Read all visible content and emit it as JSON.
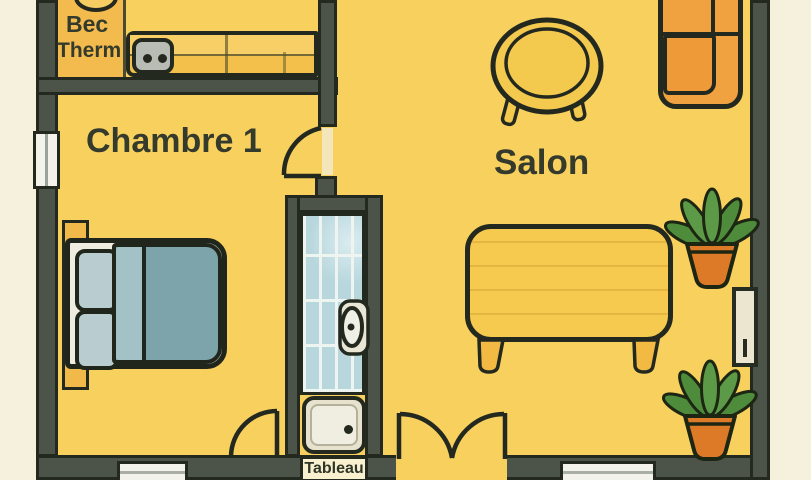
{
  "plan": {
    "rooms": {
      "kitchen": {
        "label_bec": "Bec",
        "label_therm": "Therm"
      },
      "bedroom": {
        "label": "Chambre 1"
      },
      "living_room": {
        "label": "Salon"
      },
      "electrical_panel": {
        "label": "Tableau"
      }
    },
    "furniture_icons": [
      "stove-burner",
      "power-outlet",
      "kitchen-counter",
      "double-bed",
      "pillow",
      "pillow",
      "coffee-table",
      "yellow-sofa",
      "orange-sectional-sofa",
      "toilet",
      "shower-tray",
      "wall-panel",
      "potted-plant",
      "potted-plant",
      "door-swing",
      "door-swing",
      "double-door-swing",
      "window",
      "window",
      "window"
    ],
    "colors": {
      "background_outside": "#f6f1dd",
      "wall": "#4c5349",
      "outline": "#23291f",
      "floor": "#f8d05e",
      "alcove": "#f3ba4d",
      "counter": "#f3c04c",
      "bed_blanket": "#7ca4aa",
      "bed_fold": "#a3c2c6",
      "pillow": "#b9cdd0",
      "sofa_yellow": "#f6c94f",
      "sectional_orange": "#f0a140",
      "tile_blue": "#b7d7dd",
      "plant_green": "#4e8c3b",
      "pot_orange": "#dd7a27",
      "label_text": "#343b2c"
    }
  }
}
